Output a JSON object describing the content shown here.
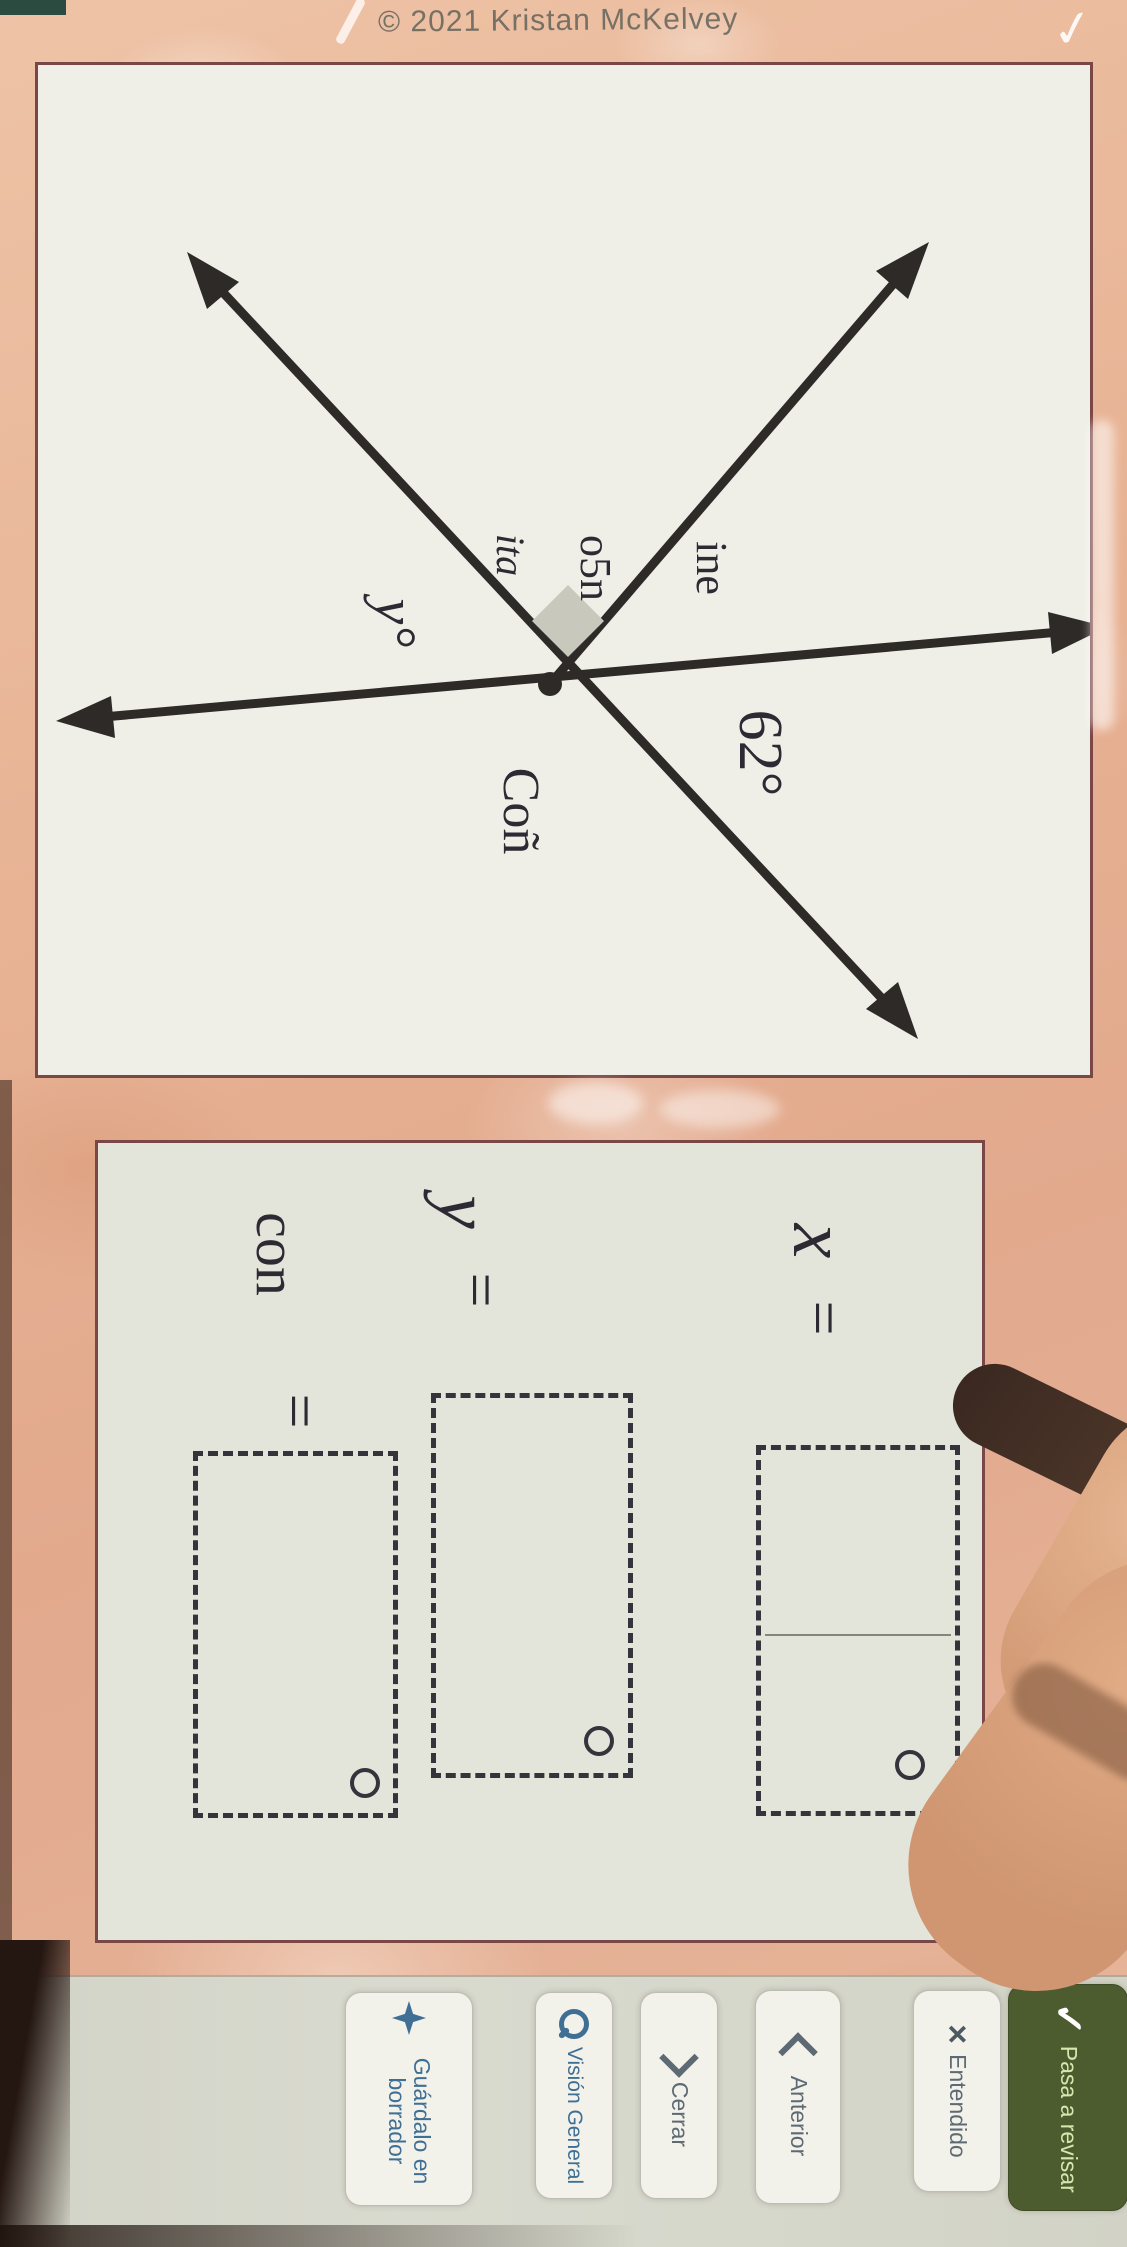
{
  "copyright": "© 2021 Kristan McKelvey",
  "diagram": {
    "angle_given": "62°",
    "angle_y": "y°",
    "scribble_1": "ine",
    "scribble_2": "o5n",
    "scribble_3": "ita",
    "scribble_4": "Coñ"
  },
  "answers": {
    "rows": [
      {
        "variable": "x",
        "equals": "="
      },
      {
        "variable": "y",
        "equals": "="
      },
      {
        "variable": "con",
        "equals": "="
      }
    ]
  },
  "toolbar": {
    "buttons": [
      {
        "icon": "sparkle-star-icon",
        "label": "Guárdalo en borrador"
      },
      {
        "icon": "magnifier-icon",
        "label": "Visión General"
      },
      {
        "icon": "chevron-right-icon",
        "label": "Cerrar"
      },
      {
        "icon": "chevron-left-icon",
        "label": "Anterior"
      },
      {
        "icon": "close-x-icon",
        "label": "Entendido"
      },
      {
        "icon": "checkmark-icon",
        "label": "Pasa a revisar"
      }
    ]
  },
  "colors": {
    "background": "#e7b193",
    "panel_border": "#7a4747",
    "diagram_bg": "#f0efe7",
    "answers_bg": "#e3e4da",
    "ink": "#2d2a33",
    "accent_blue": "#3f6f95",
    "primary_green": "#4d5c2f",
    "primary_green_text": "#d7e8ae",
    "toolbar_bg": "#d6d8cc"
  }
}
